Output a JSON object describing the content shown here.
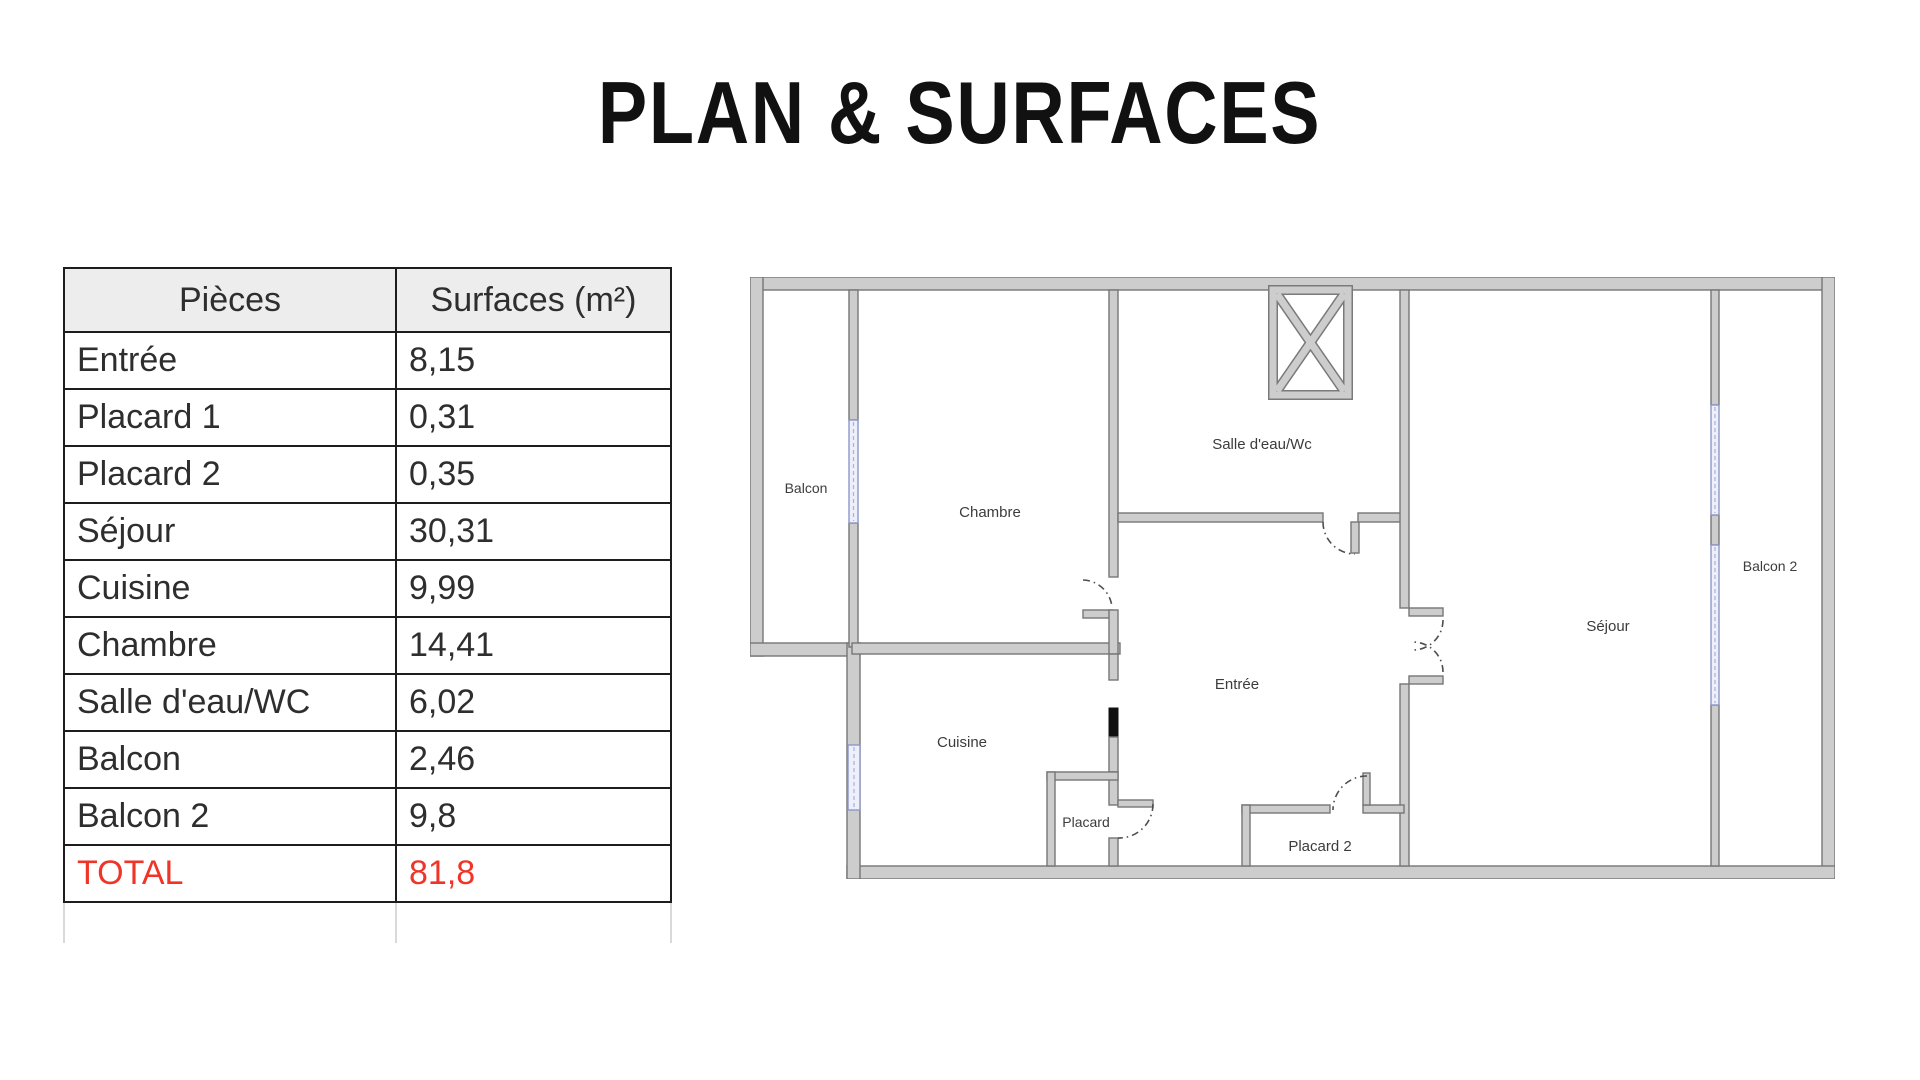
{
  "title": "PLAN & SURFACES",
  "table": {
    "headers": {
      "pieces": "Pièces",
      "surfaces": "Surfaces (m²)"
    },
    "rows": [
      {
        "piece": "Entrée",
        "surface": "8,15"
      },
      {
        "piece": "Placard 1",
        "surface": "0,31"
      },
      {
        "piece": "Placard 2",
        "surface": "0,35"
      },
      {
        "piece": "Séjour",
        "surface": "30,31"
      },
      {
        "piece": "Cuisine",
        "surface": "9,99"
      },
      {
        "piece": "Chambre",
        "surface": "14,41"
      },
      {
        "piece": "Salle d'eau/WC",
        "surface": "6,02"
      },
      {
        "piece": "Balcon",
        "surface": "2,46"
      },
      {
        "piece": "Balcon 2",
        "surface": "9,8"
      }
    ],
    "total": {
      "piece": "TOTAL",
      "surface": "81,8"
    },
    "total_color": "#f03528"
  },
  "plan": {
    "labels": {
      "balcon": "Balcon",
      "chambre": "Chambre",
      "salle_eau": "Salle d'eau/Wc",
      "entree": "Entrée",
      "cuisine": "Cuisine",
      "placard": "Placard",
      "placard2": "Placard 2",
      "sejour": "Séjour",
      "balcon2": "Balcon 2"
    },
    "wall_color": "#cdcdcd",
    "window_color": "#8e97c6"
  }
}
